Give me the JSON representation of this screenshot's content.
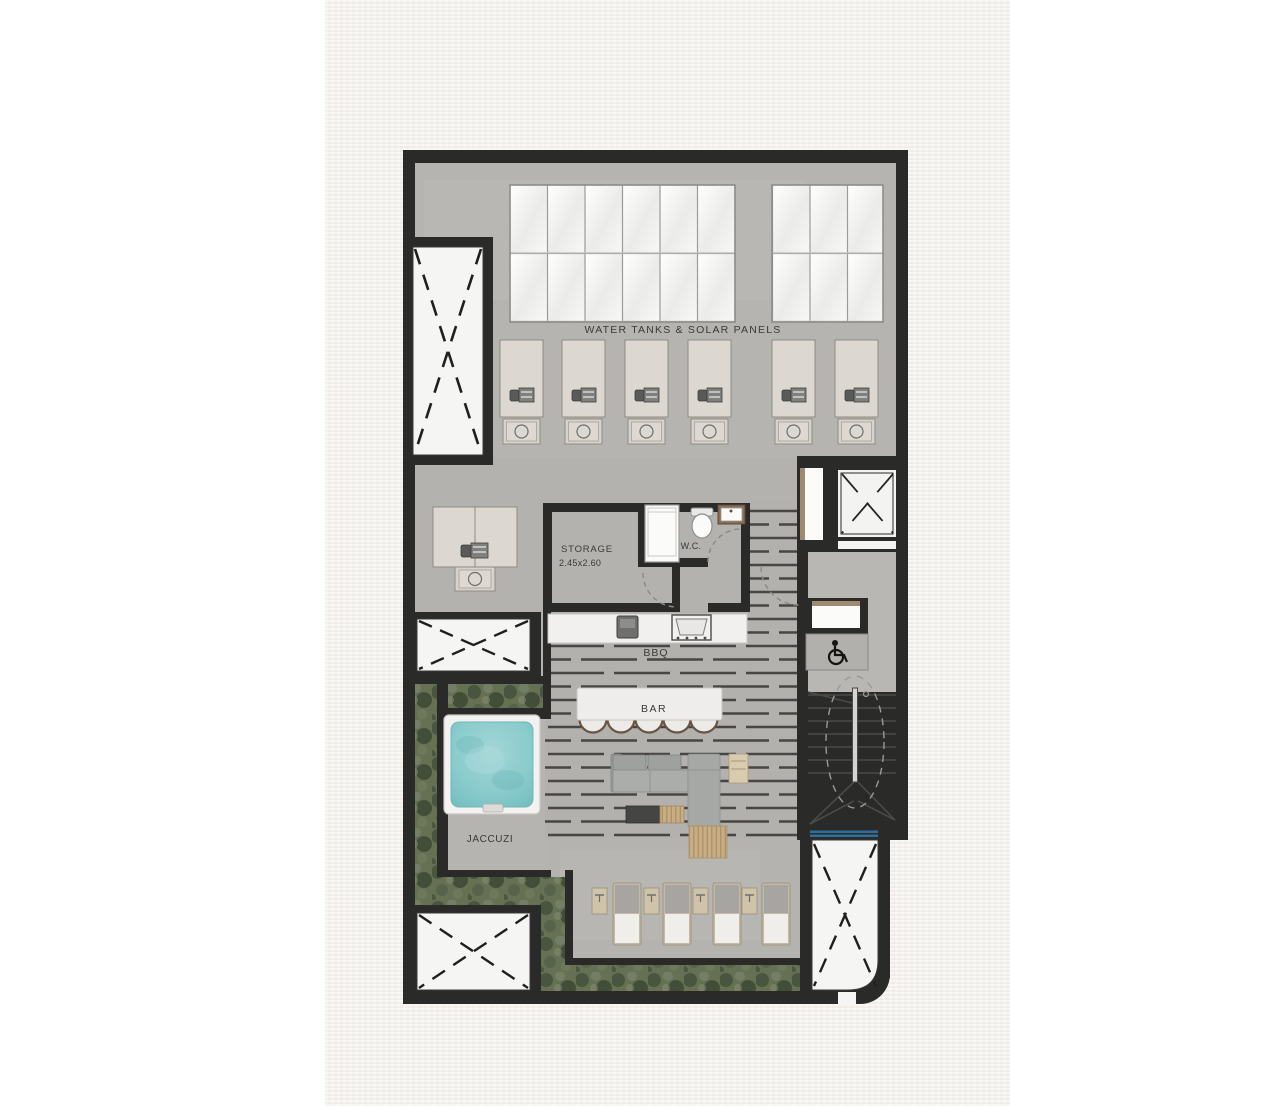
{
  "page": {
    "margin_color": "#ffffff",
    "paper_color": "#f5f3ee",
    "drawing_type": "roof terrace floor plan"
  },
  "plan": {
    "labels": {
      "water_tanks": "WATER TANKS & SOLAR PANELS",
      "storage": "STORAGE",
      "storage_dims": "2.45x2.60",
      "wc": "W.C.",
      "bbq": "BBQ",
      "bar": "BAR",
      "jacuzzi": "JACCUZI"
    },
    "icons": {
      "wheelchair_icon": "wheelchair-access",
      "void_cross_icon": "dashed-x-void",
      "elevator_cross_icon": "elevator-x"
    },
    "colors": {
      "wall": "#2a2a28",
      "concrete": "#b6b4b1",
      "deck_base": "#b3b1ae",
      "deck_line": "#474644",
      "green": "#667052",
      "jacuzzi_water": "#85c8cb",
      "guard_blue": "#2f6f9c",
      "wood": "#c9ae85",
      "shaft_white": "#f5f5f3",
      "counter_white": "#f1f0ee"
    }
  }
}
